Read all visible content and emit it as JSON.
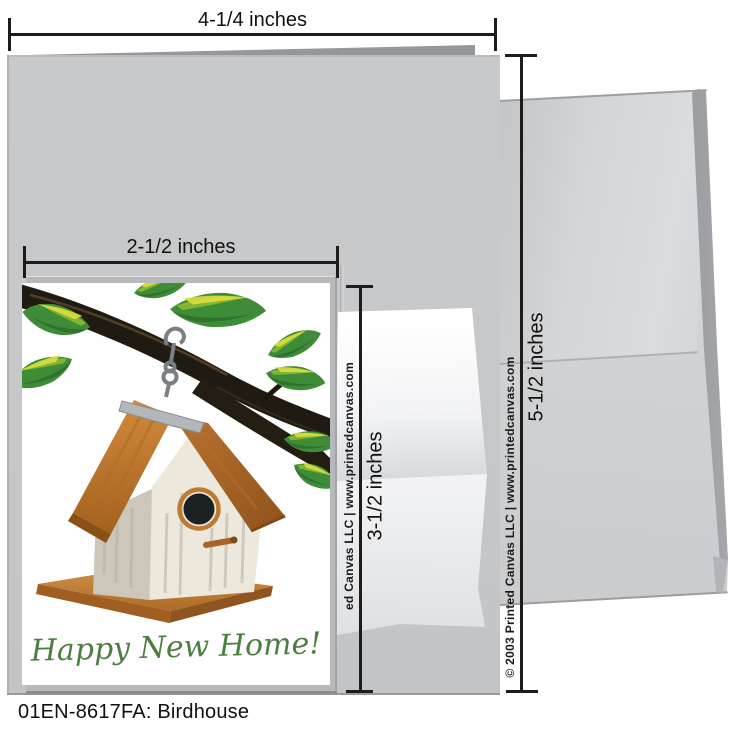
{
  "product": {
    "caption": "01EN-8617FA: Birdhouse"
  },
  "card": {
    "greeting": "Happy New Home!"
  },
  "measurements": {
    "full_card_width": "4-1/4 inches",
    "front_panel_width": "2-1/2 inches",
    "front_panel_height": "3-1/2 inches",
    "full_card_height": "5-1/2 inches"
  },
  "watermarks": {
    "inner_column": "ed Canvas LLC | www.printedcanvas.com",
    "outer_column": "© 2003 Printed Canvas LLC | www.printedcanvas.com"
  },
  "colors": {
    "card_gray": "#c5c7c9",
    "envelope_gray": "#d2d4d6",
    "greeting_green": "#4d7d42",
    "roof_orange": "#c07a30",
    "leaf_green": "#3f8c38",
    "branch_black": "#1f1a12",
    "measure_black": "#1c1c1c"
  }
}
